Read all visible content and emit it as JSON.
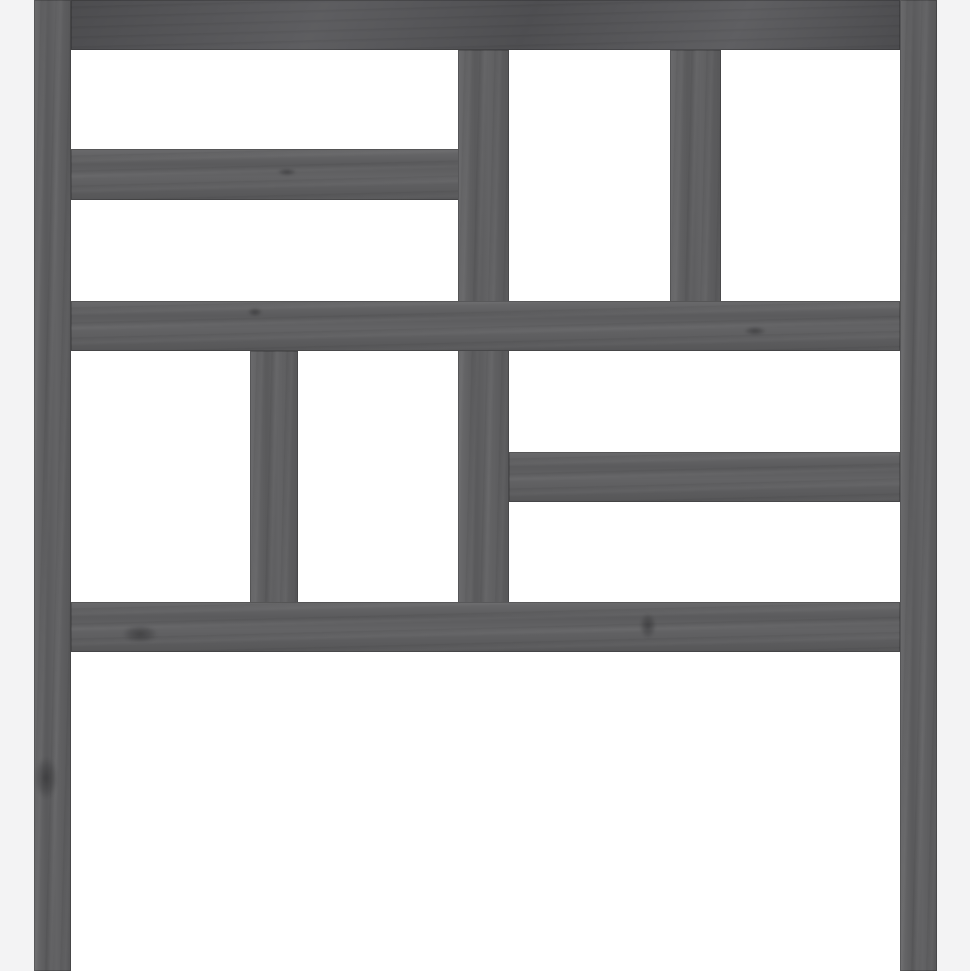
{
  "image": {
    "description": "E-commerce product photograph of a gray solid pinewood bed headboard with a geometric lattice of rectangular boards and open white gaps, standing on two long legs, on a plain white background",
    "object": "wooden headboard",
    "finish": "gray stained pine with visible grain knots",
    "background_color": "#ffffff",
    "side_margin_color": "#f3f3f4",
    "wood_colors": {
      "base": "#5e5e60",
      "dark_tone": "#555558",
      "grain_dark": "#47474a",
      "seam": "rgba(0,0,0,0.18)"
    }
  },
  "canvas": {
    "width": 970,
    "height": 971
  },
  "margins": {
    "left_width": 34,
    "right_width": 33
  },
  "pieces": [
    {
      "name": "slat-top-left",
      "x": 71,
      "y": 149,
      "w": 389,
      "h": 51,
      "orient": "h",
      "tone": "base"
    },
    {
      "name": "slat-right",
      "x": 509,
      "y": 452,
      "w": 391,
      "h": 50,
      "orient": "h",
      "tone": "base"
    },
    {
      "name": "divider-center",
      "x": 458,
      "y": 50,
      "w": 51,
      "h": 553,
      "orient": "v",
      "tone": "base"
    },
    {
      "name": "divider-top-right",
      "x": 670,
      "y": 50,
      "w": 51,
      "h": 253,
      "orient": "v",
      "tone": "base"
    },
    {
      "name": "divider-bottom-left",
      "x": 250,
      "y": 351,
      "w": 48,
      "h": 253,
      "orient": "v",
      "tone": "base"
    },
    {
      "name": "middle-beam",
      "x": 71,
      "y": 301,
      "w": 829,
      "h": 50,
      "orient": "h",
      "tone": "base"
    },
    {
      "name": "bottom-beam",
      "x": 71,
      "y": 602,
      "w": 829,
      "h": 50,
      "orient": "h",
      "tone": "base"
    },
    {
      "name": "top-beam",
      "x": 71,
      "y": 0,
      "w": 829,
      "h": 50,
      "orient": "h",
      "tone": "dark"
    },
    {
      "name": "left-post",
      "x": 34,
      "y": 0,
      "w": 37,
      "h": 971,
      "orient": "v",
      "tone": "base"
    },
    {
      "name": "right-post",
      "x": 900,
      "y": 0,
      "w": 37,
      "h": 971,
      "orient": "v",
      "tone": "base"
    }
  ],
  "knots": [
    {
      "name": "knot-left-post",
      "x": 46,
      "y": 778,
      "rx": 16,
      "ry": 28
    },
    {
      "name": "knot-bottom-beam-left",
      "x": 140,
      "y": 634,
      "rx": 24,
      "ry": 12
    },
    {
      "name": "knot-middle-beam",
      "x": 255,
      "y": 312,
      "rx": 10,
      "ry": 6
    },
    {
      "name": "knot-bottom-beam-mid",
      "x": 648,
      "y": 626,
      "rx": 11,
      "ry": 17
    },
    {
      "name": "knot-slat-top-left",
      "x": 287,
      "y": 172,
      "rx": 13,
      "ry": 5
    },
    {
      "name": "knot-middle-beam-right",
      "x": 755,
      "y": 331,
      "rx": 15,
      "ry": 6
    }
  ]
}
